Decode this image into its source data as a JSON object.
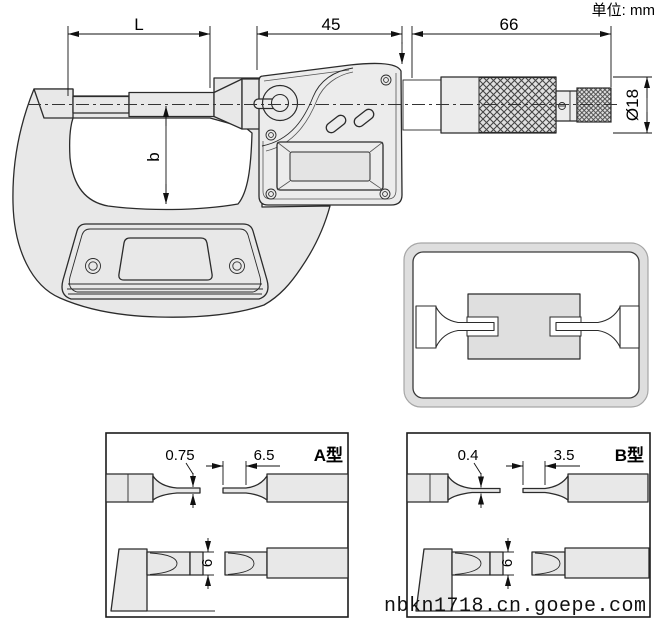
{
  "unit_label": "单位: mm",
  "dims": {
    "L": "L",
    "d45": "45",
    "d66": "66",
    "dia": "Ø18",
    "b": "b"
  },
  "panel_a": {
    "title": "A型",
    "blade_thickness": "0.75",
    "blade_tip_length": "6.5",
    "blade_width": "6"
  },
  "panel_b": {
    "title": "B型",
    "blade_thickness": "0.4",
    "blade_tip_length": "3.5",
    "blade_width": "6"
  },
  "watermark": "nbkn1718.cn.goepe.com",
  "colors": {
    "body_fill": "#e8e8e8",
    "line": "#2b2b2b",
    "background": "#ffffff"
  }
}
